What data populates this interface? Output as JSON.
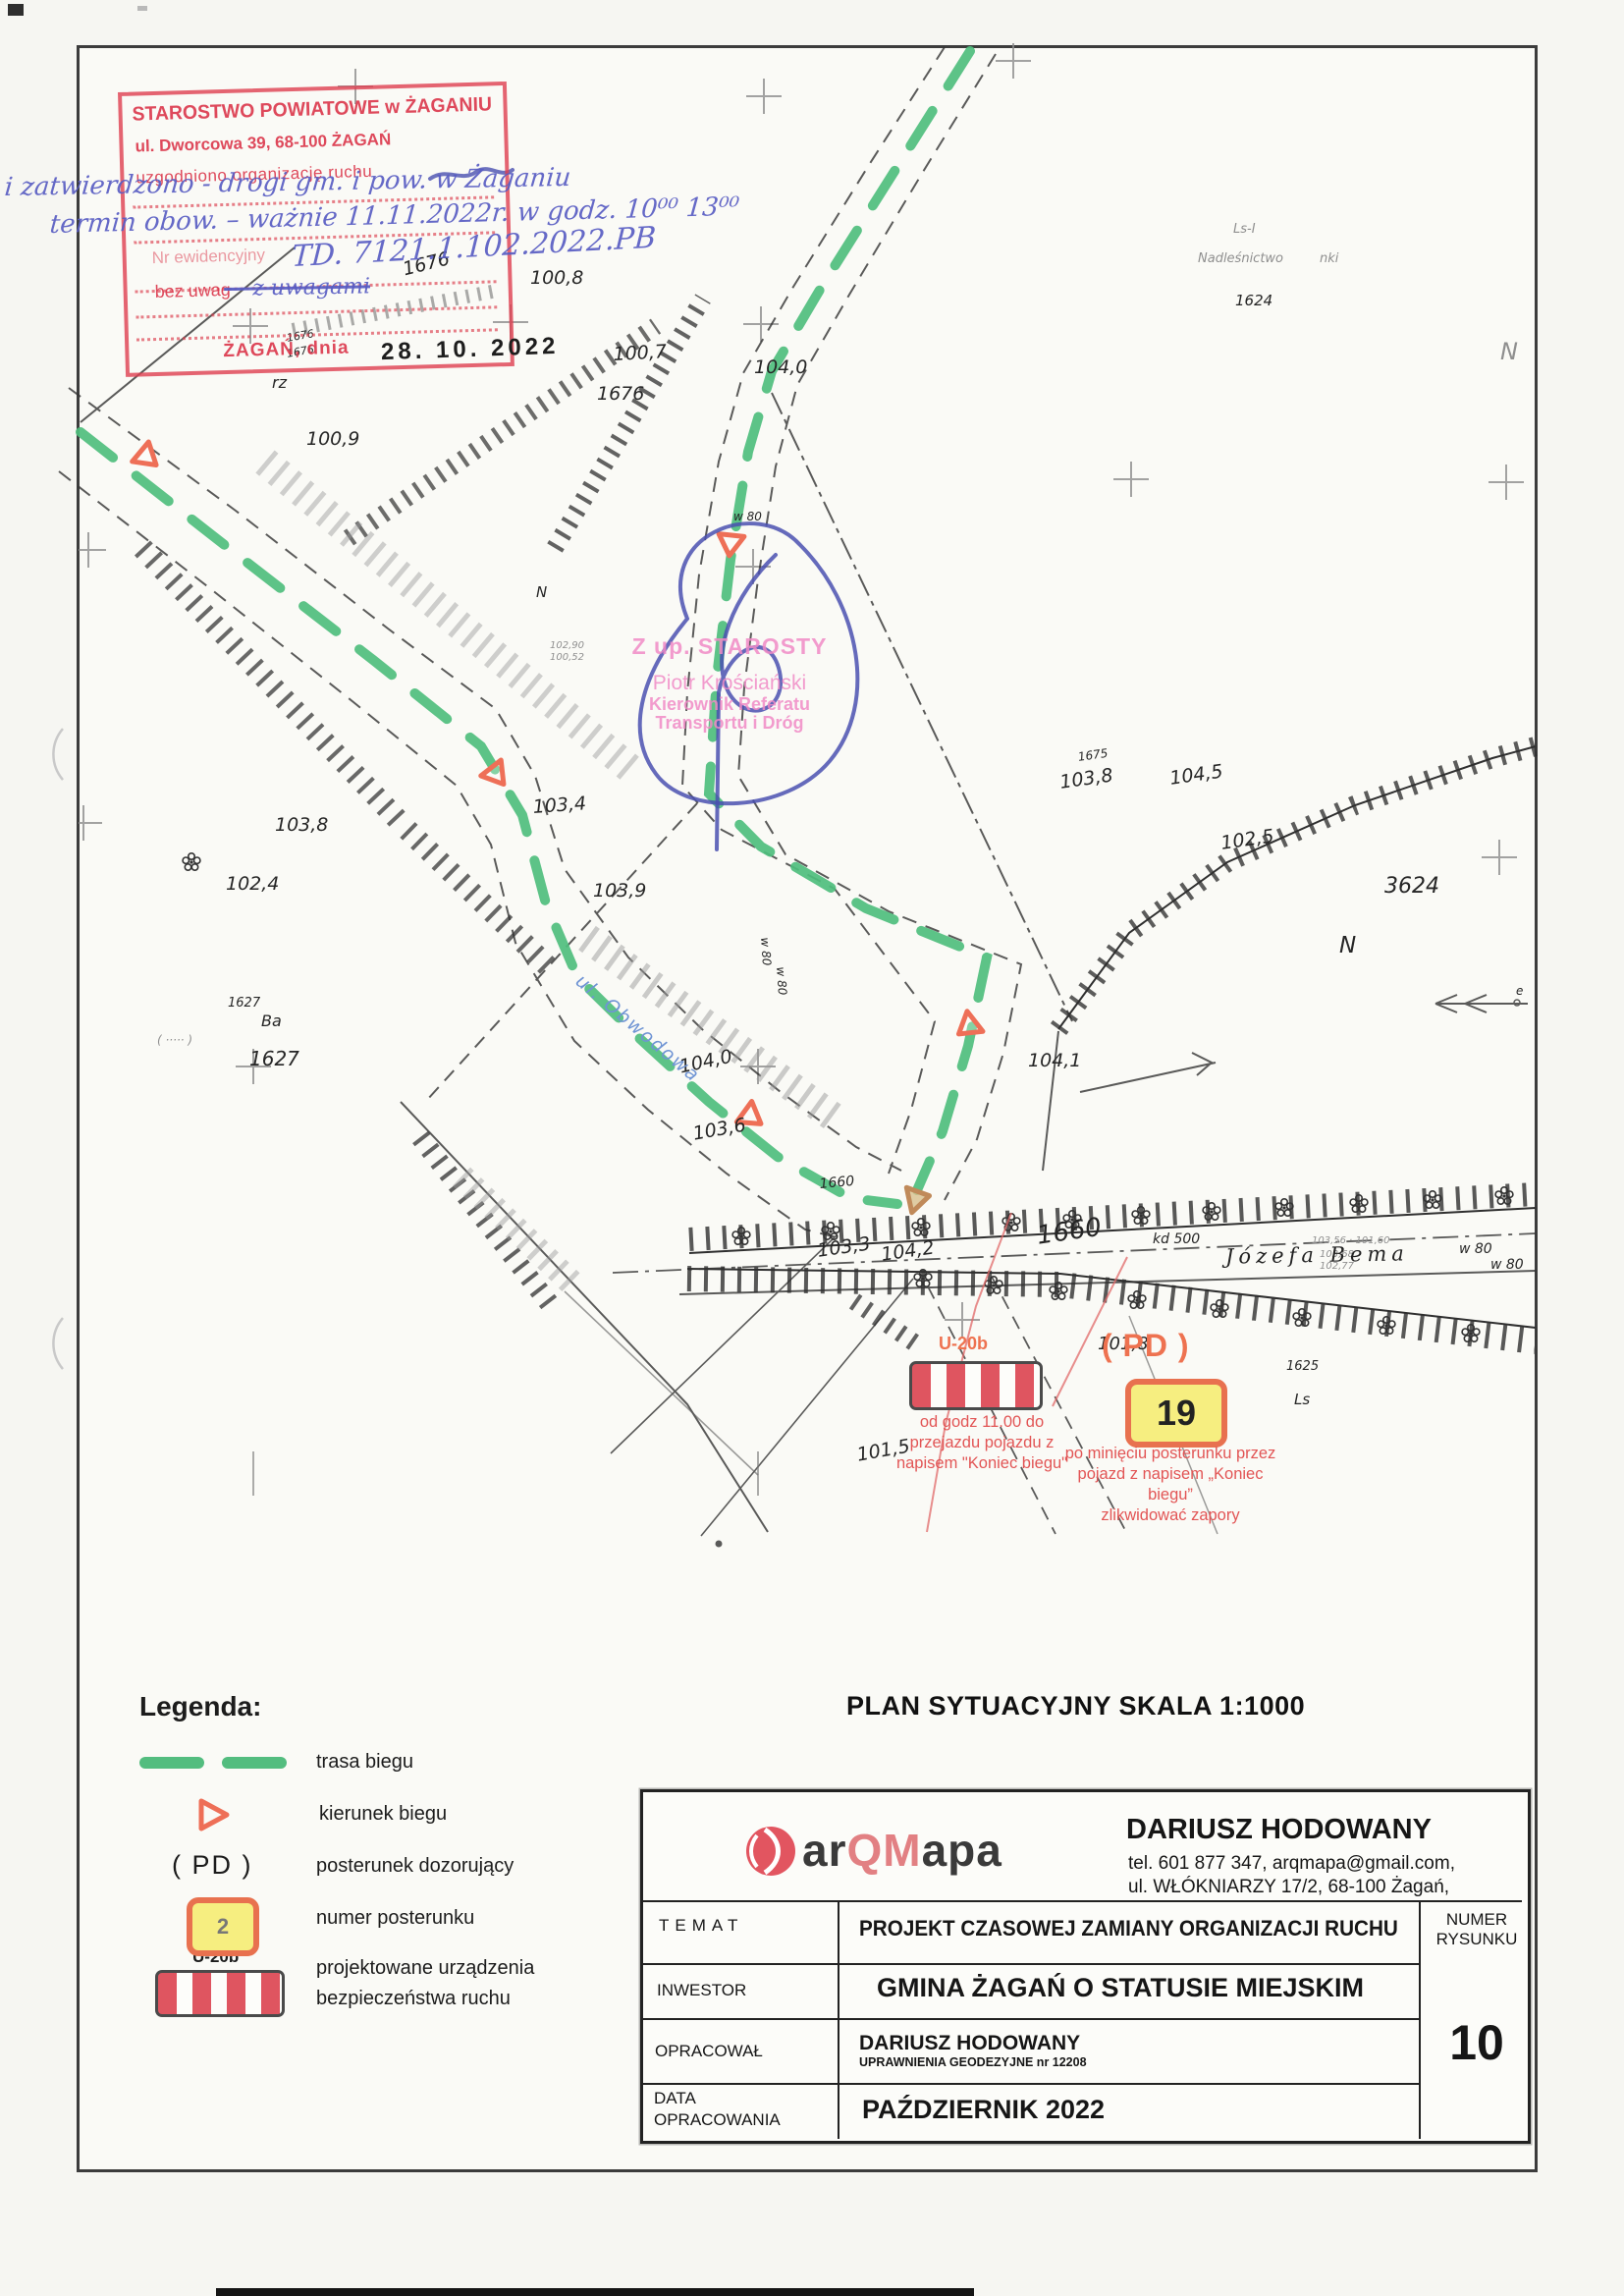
{
  "doc": {
    "plan_title": "PLAN SYTUACYJNY SKALA 1:1000"
  },
  "stamp": {
    "title": "STAROSTWO POWIATOWE w ŻAGANIU",
    "address": "ul. Dworcowa 39,    68-100 ŻAGAŃ",
    "agreed": "uzgodniono organizację ruchu",
    "nr_label": "Nr ewidencyjny",
    "no_remarks": "bez uwag",
    "with_remarks": "— z uwagami",
    "city_date": "ŻAGAŃ, dnia",
    "date": "28. 10. 2022",
    "parcel_note": "1676"
  },
  "handwriting": {
    "line1": "i zatwierdzono - drogi gm. i pow. w Żaganiu",
    "line2": "termin obow. – ważnie 11.11.2022r. w godz. 10⁰⁰ 13⁰⁰",
    "line3": "TD. 7121.1.102.2022.PB"
  },
  "approval": {
    "l1": "Z up. STAROSTY",
    "l2": "Piotr Krościański",
    "l3": "Kierownik Referatu",
    "l4": "Transportu i Dróg"
  },
  "map": {
    "street_obwodowa": "ul. Obwodowa",
    "street_bema": "Józefa Bema",
    "labels": [
      "1676",
      "100,8",
      "1676",
      "1676",
      "Ls-I",
      "Nadleśnictwo",
      "nki",
      "1624",
      "100,7",
      "104,0",
      "N",
      "rz",
      "100,9",
      "102,90",
      "100,52",
      "N",
      "1675",
      "103,8",
      "104,5",
      "102,5",
      "3624",
      "N",
      "e",
      "103,8",
      "102,4",
      "103,4",
      "103,9",
      "w 80",
      "w 80",
      "w 80",
      "1627",
      "Ba",
      "( ····· )",
      "1627",
      "104,0",
      "103,6",
      "1660",
      "104,1",
      "103,3",
      "104,2",
      "1660",
      "kd 500",
      "103,56 · 101,60",
      "103,68",
      "102,77",
      "w 80",
      "w 80",
      "101,5",
      "101,8",
      "1625",
      "Ls"
    ]
  },
  "annotations": {
    "u20b": "U-20b",
    "pd": "( PD )",
    "post_number": "19",
    "caption_left": [
      "od godz 11.00 do",
      "przejazdu pojazdu z",
      "napisem \"Koniec biegu\""
    ],
    "caption_right": [
      "po minięciu posterunku przez",
      "pojazd z napisem „Koniec biegu”",
      "zlikwidować zapory"
    ]
  },
  "legend": {
    "title": "Legenda:",
    "route": "trasa biegu",
    "direction": "kierunek biegu",
    "pd_symbol": "( PD )",
    "pd_label": "posterunek dozorujący",
    "number_sample": "2",
    "number_label": "numer posterunku",
    "u20b": "U-20b",
    "devices_line1": "projektowane urządzenia",
    "devices_line2": "bezpieczeństwa ruchu"
  },
  "title_block": {
    "logo_ar": "ar",
    "logo_qm": "QM",
    "logo_apa": "apa",
    "author": "DARIUSZ HODOWANY",
    "contact": "tel. 601 877 347,   arqmapa@gmail.com,",
    "address": "ul. WŁÓKNIARZY 17/2, 68-100 Żagań,",
    "temat_label": "TEMAT",
    "temat": "PROJEKT CZASOWEJ ZAMIANY ORGANIZACJI RUCHU",
    "inwestor_label": "INWESTOR",
    "inwestor": "GMINA ŻAGAŃ O STATUSIE MIEJSKIM",
    "opracowal_label": "OPRACOWAŁ",
    "opracowal": "DARIUSZ HODOWANY",
    "opracowal_sub": "UPRAWNIENIA GEODEZYJNE nr 12208",
    "data_label1": "DATA",
    "data_label2": "OPRACOWANIA",
    "data_value": "PAŹDZIERNIK 2022",
    "numer_label1": "NUMER",
    "numer_label2": "RYSUNKU",
    "numer_value": "10"
  },
  "colors": {
    "route_green": "#53bd7f",
    "stamp_red": "#de3e50",
    "annotation_orange": "#ee7250",
    "barrier_red": "#df5560",
    "handwriting_blue": "#585cc2",
    "approval_pink": "#f08ac5"
  }
}
